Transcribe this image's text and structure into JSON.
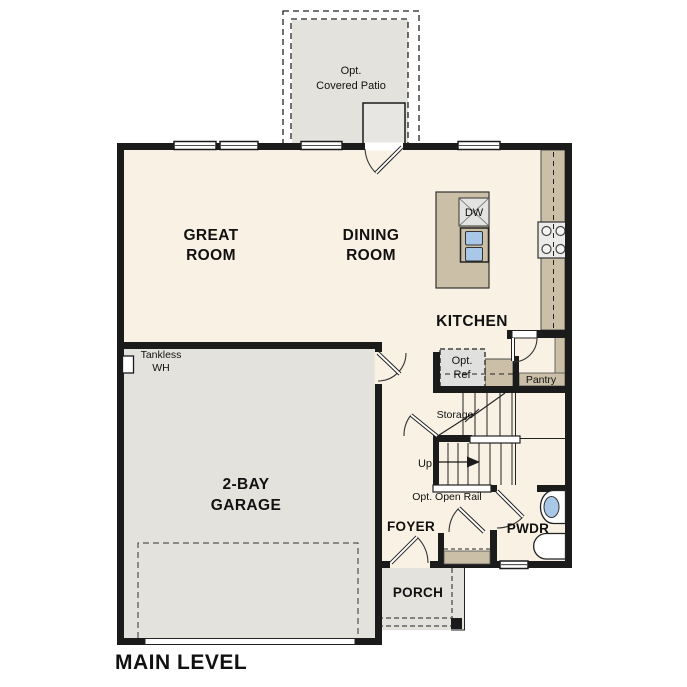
{
  "plan": {
    "title": "MAIN LEVEL",
    "rooms": {
      "great_room": {
        "line1": "GREAT",
        "line2": "ROOM"
      },
      "dining_room": {
        "line1": "DINING",
        "line2": "ROOM"
      },
      "kitchen": {
        "label": "KITCHEN"
      },
      "garage": {
        "line1": "2-BAY",
        "line2": "GARAGE"
      },
      "foyer": {
        "label": "FOYER"
      },
      "powder_room": {
        "label": "PWDR"
      },
      "porch": {
        "label": "PORCH"
      },
      "covered_patio": {
        "line1": "Opt.",
        "line2": "Covered Patio"
      },
      "pantry": {
        "label": "Pantry"
      },
      "storage": {
        "label": "Storage"
      }
    },
    "annotations": {
      "tankless_wh": {
        "line1": "Tankless",
        "line2": "WH"
      },
      "dishwasher": {
        "label": "DW"
      },
      "opt_ref": {
        "line1": "Opt.",
        "line2": "Ref"
      },
      "stairs_up": {
        "label": "Up"
      },
      "opt_open_rail": {
        "label": "Opt. Open Rail"
      }
    },
    "colors": {
      "wall": "#1b1b1b",
      "interior": "#f8f1e4",
      "garage_porch_patio": "#e3e2dd",
      "counter": "#cbc0a7",
      "fixture_blue": "#a9c7e7",
      "appliance": "#ebebe9",
      "background": "#ffffff"
    }
  }
}
